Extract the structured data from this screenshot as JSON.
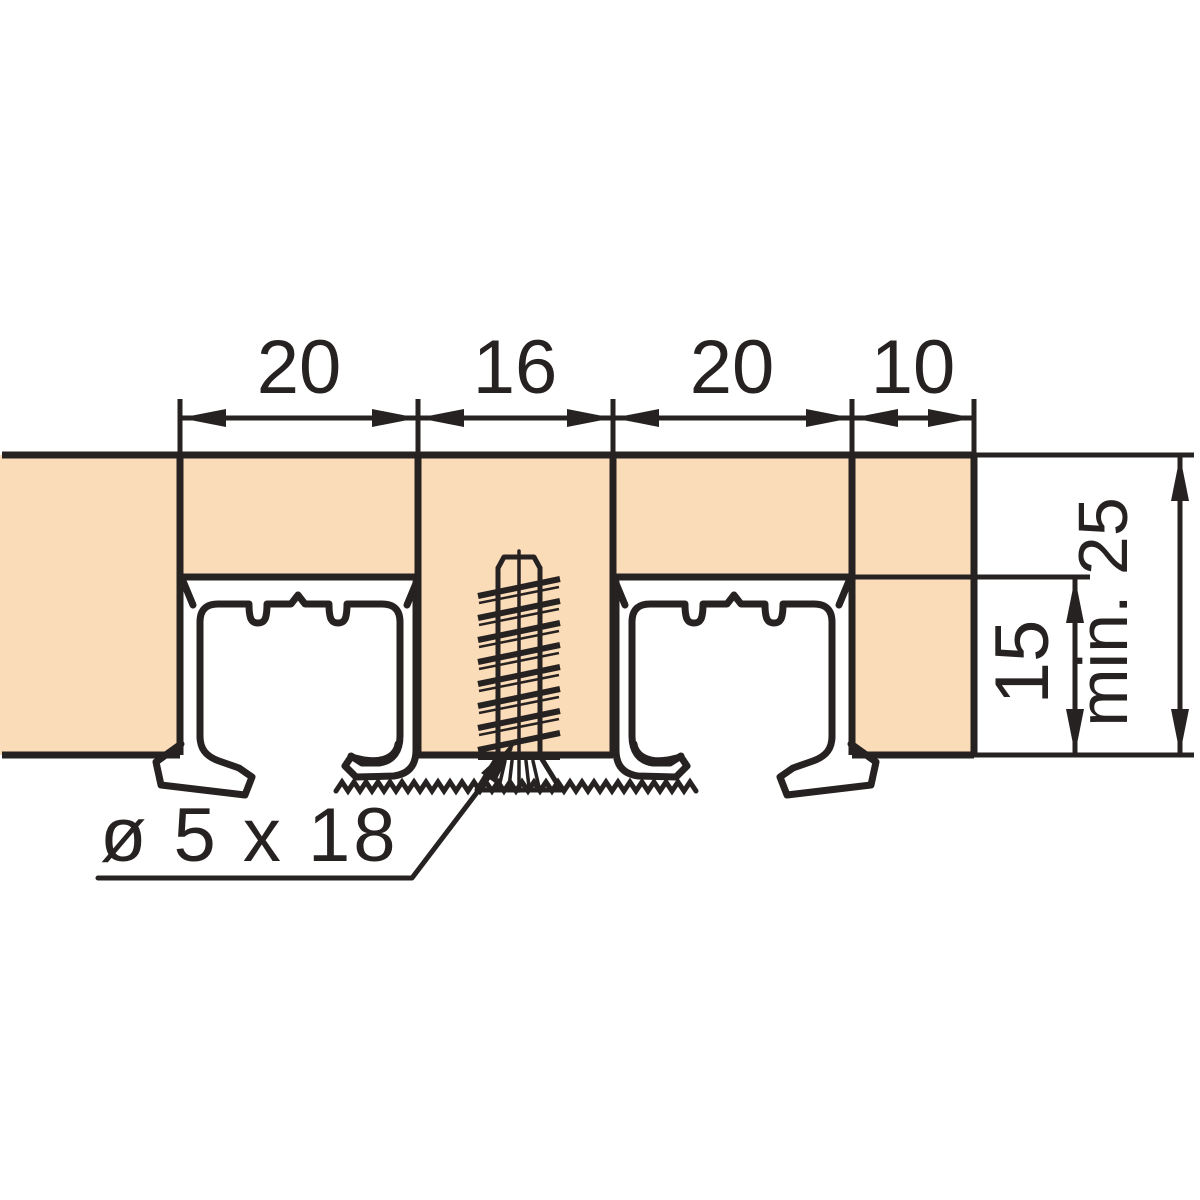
{
  "diagram": {
    "type": "technical-section-drawing",
    "subject": "double sliding-door top track set in grooves of a wood panel, fixed with a countersunk screw",
    "top_dimensions": [
      {
        "value": "20"
      },
      {
        "value": "16"
      },
      {
        "value": "20"
      },
      {
        "value": "10"
      }
    ],
    "right_dimensions": [
      {
        "value": "15"
      },
      {
        "value": "min. 25"
      }
    ],
    "callouts": [
      {
        "value": "ø 5 x 18"
      }
    ]
  },
  "colors": {
    "wood_fill": "#fbdcb9",
    "line": "#272222",
    "background": "#ffffff"
  }
}
